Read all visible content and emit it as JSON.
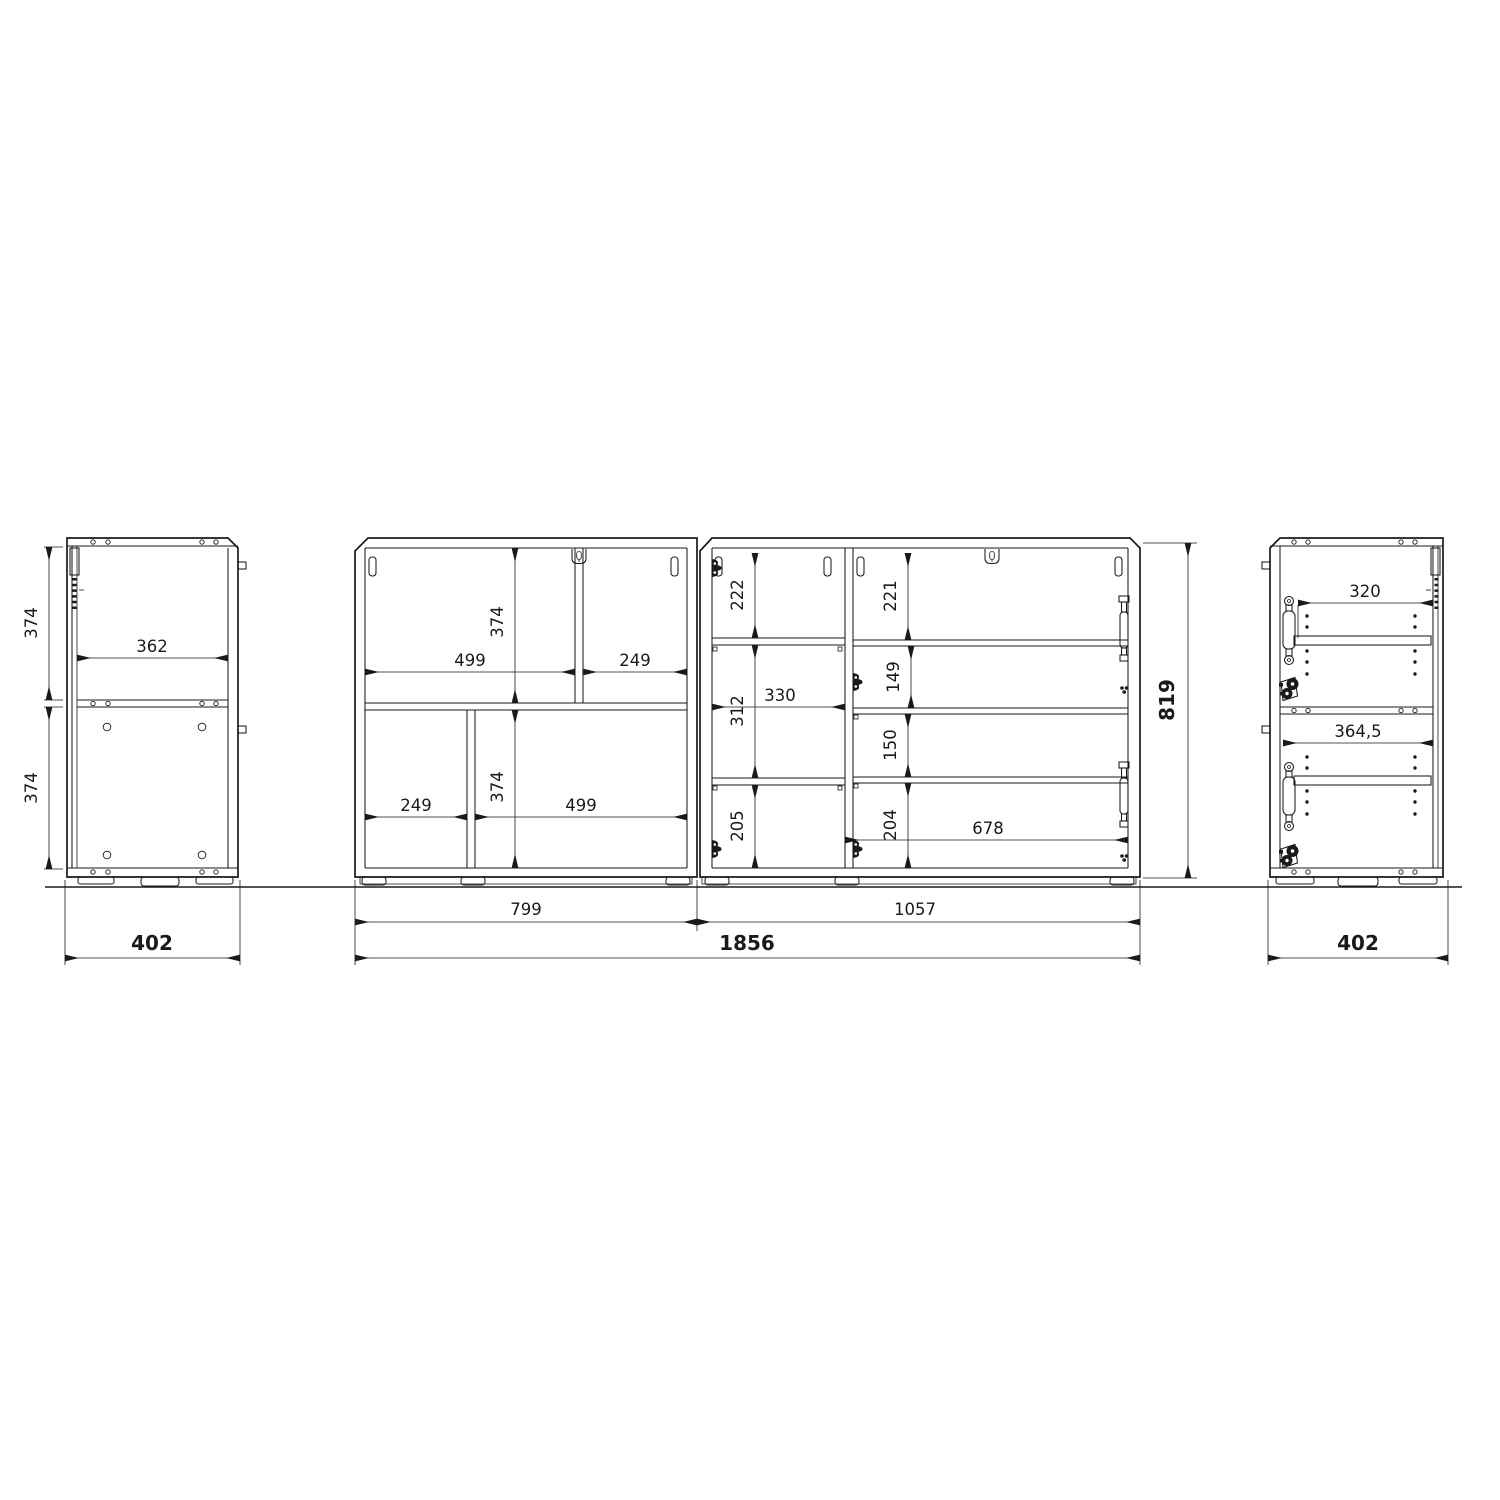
{
  "colors": {
    "line": "#1a1a1a",
    "background": "#ffffff"
  },
  "views": {
    "left_side": {
      "depth": "402",
      "inner_width": "362",
      "upper_section_height": "374",
      "lower_section_height": "374"
    },
    "front_left_cabinet": {
      "width": "799",
      "top_left_compartment_width": "499",
      "top_right_compartment_width": "249",
      "top_section_height": "374",
      "bottom_left_compartment_width": "249",
      "bottom_right_compartment_width": "499",
      "bottom_section_height": "374"
    },
    "front_right_cabinet": {
      "width": "1057",
      "left_column_top_height": "222",
      "left_column_middle_height": "312",
      "left_column_width": "330",
      "left_column_bottom_height": "205",
      "right_column_height_1": "221",
      "right_column_height_2": "149",
      "right_column_height_3": "150",
      "right_column_height_4": "204",
      "right_column_inner_width": "678"
    },
    "right_side": {
      "depth": "402",
      "upper_inner_width": "320",
      "lower_inner_width": "364,5"
    },
    "overall": {
      "total_width": "1856",
      "total_height": "819"
    }
  }
}
